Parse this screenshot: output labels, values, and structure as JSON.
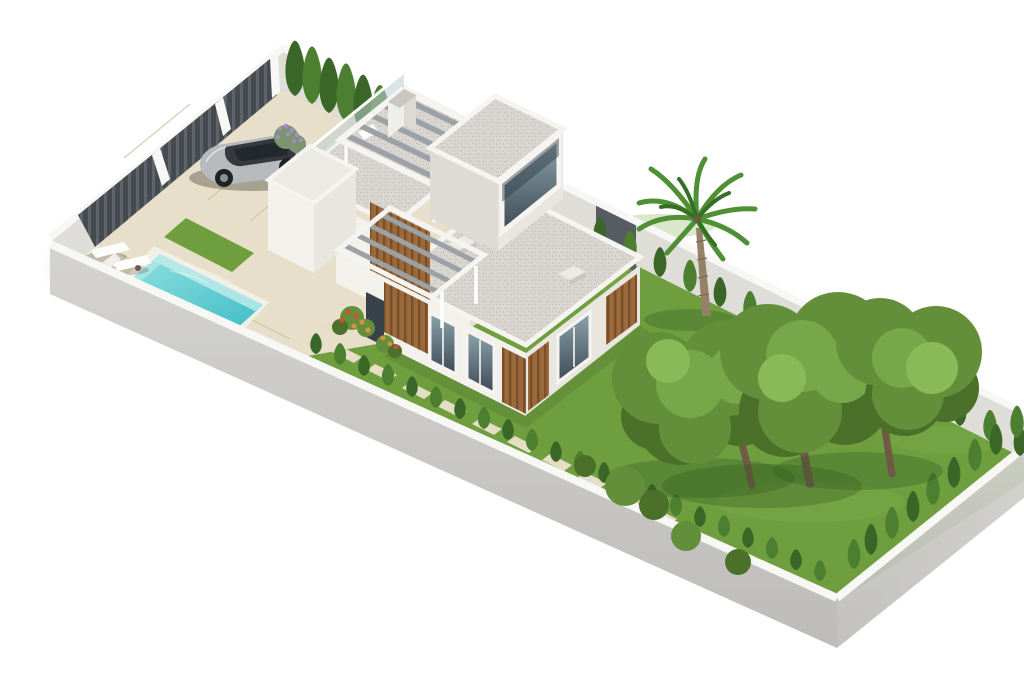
{
  "scene": {
    "title": "Modern villa plot – 3D render",
    "description": "Isometric 3D architectural rendering of a walled rectangular plot containing a modern white flat-roof villa with wood slat accents, a rooftop pergola and chimney, an entrance pergola, a turquoise swimming pool with two sun loungers, a silver car parked on the driveway behind a dark slatted gate, cypress hedges along the perimeter walls, stepping stones across the lawn, a palm tree and three large garden trees."
  },
  "objects": {
    "plot": "Walled rectangular plot",
    "lawn": "Garden lawn",
    "driveway": "Beige paved driveway and pool terrace",
    "gate": "Dark slatted entrance gate",
    "pool": "Turquoise swimming pool",
    "loungers": "Two white sun loungers",
    "car": "Silver sedan parked on driveway",
    "house": "Modern white two-storey villa",
    "terrace": "Roof terrace with glass balustrade",
    "pergola_roof": "Rooftop pergola",
    "pergola_entry": "Entrance pergola",
    "chimney": "Chimney",
    "skylights": "Roof skylights",
    "windows": "Floor-to-ceiling windows with wood slat shutters",
    "hedge": "Cypress hedges along the walls",
    "stones": "Stepping stone path",
    "flowers": "Flower beds and lavender",
    "palm": "Palm tree",
    "trees": "Three large garden trees",
    "bushes": "Low garden bushes"
  },
  "colors": {
    "bg": "#ffffff",
    "grass": "#6f9e3f",
    "grassLight": "#82b14e",
    "grassShadow": "#2f5520",
    "paving": "#e7dfc9",
    "pavingJoint": "#cdc3a6",
    "stone": "#e6ddc5",
    "wallTop": "#f7f7f5",
    "wallInner": "#dfddd8",
    "wallOuter": "#d4d3cf",
    "wallOuterDark": "#bdbcb8",
    "wallDark": "#565c61",
    "slatDark": "#454b50",
    "slatLight": "#5d646a",
    "gravel": "#dad7d2",
    "gravelDot": "#c2beb8",
    "fascia": "#f5f4f1",
    "wallLight": "#f3f1ec",
    "wallShade": "#e9e6e0",
    "wallShade2": "#dedbd4",
    "wood": "#9a6a3d",
    "woodDark": "#7a4f28",
    "glassDark": "#3c4a54",
    "glassLight": "#8ea4ad",
    "water": "#90dfdd",
    "waterDeep": "#3fbdc7",
    "coping": "#f2efe7",
    "hedge": "#3a6628",
    "hedgeLight": "#4d7f31",
    "canopyDark": "#4a7029",
    "canopyMid": "#638f3a",
    "canopyLight": "#76a748",
    "canopyHi": "#8ab958",
    "trunk": "#6e5a45",
    "palmTrunk": "#948166",
    "palmLeaf": "#4f8f35",
    "palmLeafDark": "#356f24",
    "carBody": "#b7babc",
    "carTop": "#35393d",
    "carGlass": "#22282c",
    "beam": "#9ba1a5"
  }
}
